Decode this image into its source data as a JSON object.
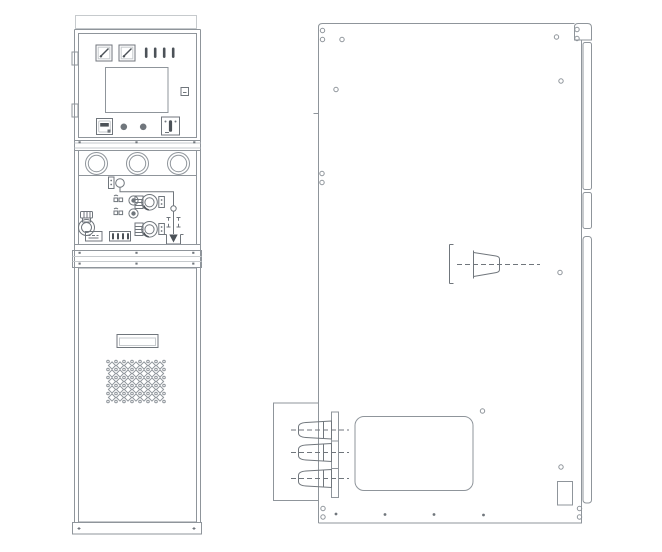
{
  "meta": {
    "title": "Switchgear cabinet outline drawing",
    "background": "#ffffff"
  },
  "palette": {
    "outline": "#a9aeb4",
    "line": "#8f959b",
    "detail": "#70767c",
    "dark": "#4c5258",
    "faint": "#c6cacd"
  },
  "front_view": {
    "label": "front-elevation",
    "components": [
      "analog-meter",
      "analog-meter",
      "indicator-lamps",
      "hmi-display",
      "aux-button",
      "energy-counter",
      "pilot-light",
      "pilot-light",
      "selector-switch",
      "round-port",
      "round-port",
      "round-port",
      "open-button",
      "close-button",
      "operation-shaft-port",
      "operation-shaft-port",
      "mimic-earth-circuit",
      "interlock-handle",
      "nameplate",
      "terminal-strip",
      "door-handle",
      "ventilation-grille",
      "base-plinth"
    ],
    "indicator_lamps": {
      "count": 4,
      "start_x": 146.2,
      "step": 9,
      "y": 47.5,
      "height": 10.5,
      "width": 2.6
    },
    "round_ports": {
      "count": 3,
      "xs": [
        96.5,
        137.5,
        178.5
      ],
      "y": 163.5,
      "r_outer": 11,
      "r_inner": 8.2
    },
    "grille": {
      "origin_x": 108,
      "origin_y": 361.5,
      "cols": 7,
      "rows": 5,
      "cell": 8
    }
  },
  "side_view": {
    "label": "side-elevation",
    "components": [
      "side-panel",
      "rear-flange-strip",
      "shaft-bushing",
      "cable-box",
      "cable-bushings",
      "access-panel",
      "vent-cutout"
    ],
    "rivet_holes": [
      [
        322.5,
        30.5
      ],
      [
        322.5,
        39.5
      ],
      [
        342,
        39.5
      ],
      [
        336,
        89.5
      ],
      [
        556.5,
        37
      ],
      [
        577,
        29.5
      ],
      [
        577,
        38.5
      ],
      [
        561,
        81
      ],
      [
        322,
        173.5
      ],
      [
        322,
        182.5
      ],
      [
        560,
        272.5
      ],
      [
        482.5,
        411
      ],
      [
        561,
        467
      ],
      [
        323,
        508.5
      ],
      [
        323,
        517
      ],
      [
        579.5,
        508.5
      ],
      [
        579.5,
        517
      ]
    ],
    "bolt_dots": [
      [
        336,
        514
      ],
      [
        385,
        514.5
      ],
      [
        434,
        514.5
      ],
      [
        483.5,
        515
      ]
    ],
    "cable_bushings": {
      "count": 3,
      "centers_y": [
        430,
        452.5,
        478.5
      ],
      "tip_x": 298.5,
      "base_x": 331.5,
      "dash_x1": 291,
      "dash_x2": 349
    }
  }
}
